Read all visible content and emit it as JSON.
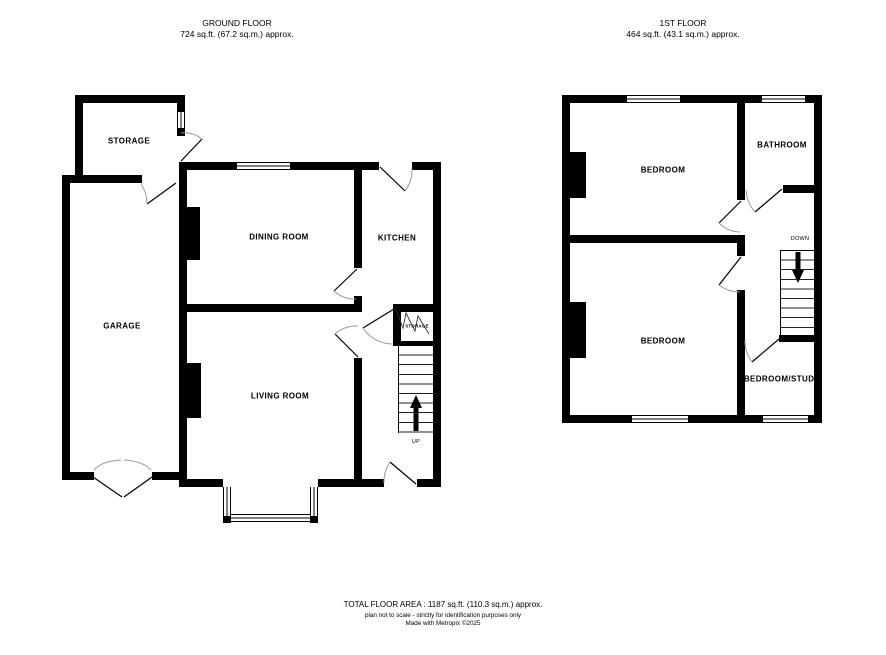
{
  "ground_floor": {
    "title": "GROUND FLOOR",
    "area": "724 sq.ft. (67.2 sq.m.) approx.",
    "rooms": {
      "storage": "STORAGE",
      "garage": "GARAGE",
      "dining_room": "DINING ROOM",
      "kitchen": "KITCHEN",
      "living_room": "LIVING ROOM",
      "understairs_storage": "STORAGE"
    },
    "stairs_label": "UP"
  },
  "first_floor": {
    "title": "1ST FLOOR",
    "area": "464 sq.ft. (43.1 sq.m.) approx.",
    "rooms": {
      "bedroom_front": "BEDROOM",
      "bathroom": "BATHROOM",
      "bedroom_back": "BEDROOM",
      "bedroom_study": "BEDROOM/STUDY"
    },
    "stairs_label": "DOWN"
  },
  "footer": {
    "total_area": "TOTAL FLOOR AREA : 1187 sq.ft. (110.3 sq.m.) approx.",
    "disclaimer": "plan not to scale - strictly for identification purposes only",
    "credit": "Made with Metropix ©2025"
  },
  "colors": {
    "wall": "#000000",
    "door_arc": "#9a9a9a",
    "background": "#ffffff"
  }
}
